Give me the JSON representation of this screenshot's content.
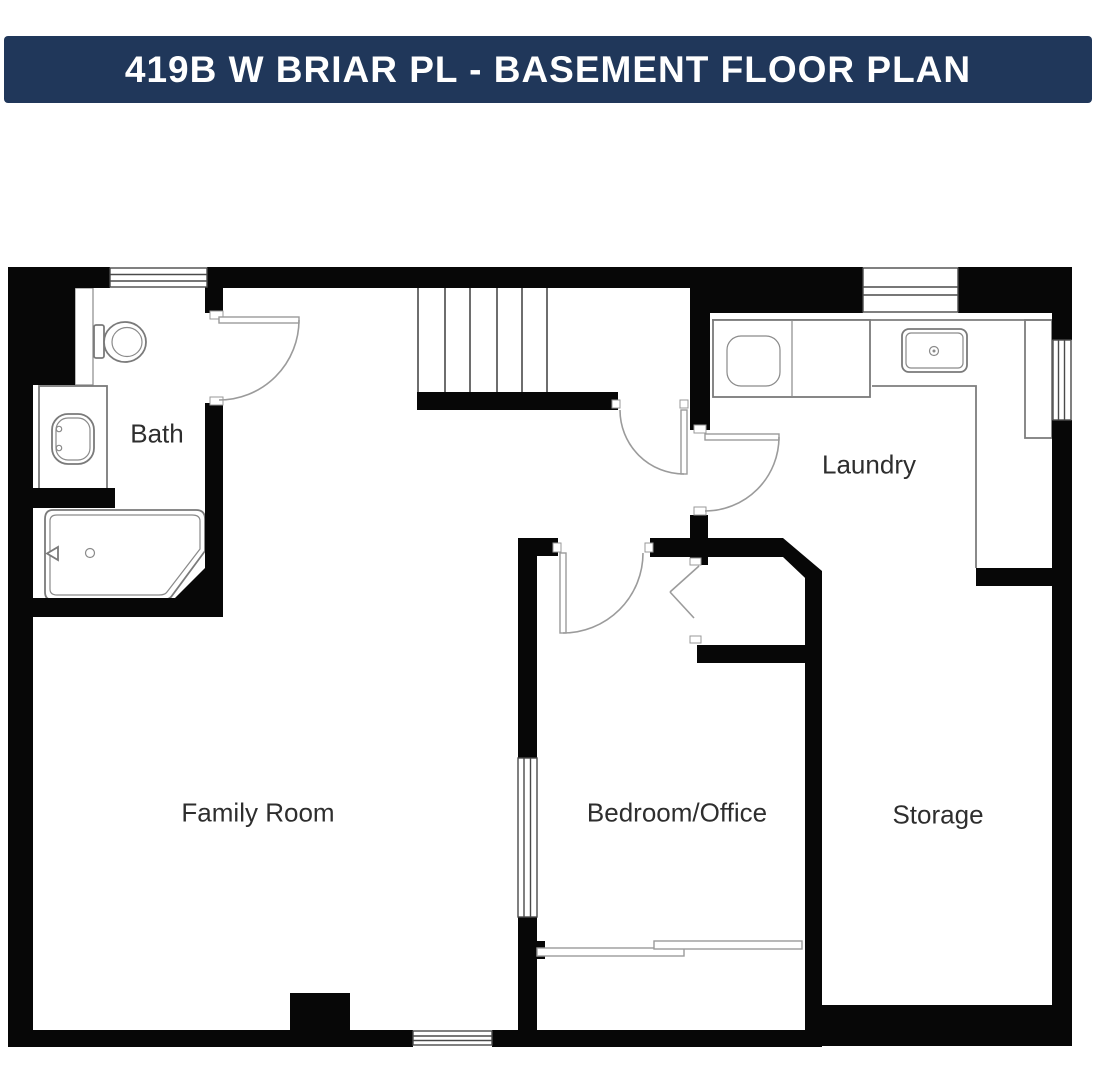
{
  "header": {
    "title": "419B W BRIAR PL - BASEMENT FLOOR PLAN"
  },
  "floor_plan": {
    "rooms": [
      {
        "name": "Bath"
      },
      {
        "name": "Laundry"
      },
      {
        "name": "Family Room"
      },
      {
        "name": "Bedroom/Office"
      },
      {
        "name": "Storage"
      }
    ],
    "fixtures": [
      "toilet",
      "bathroom-sink",
      "bathtub",
      "washer-dryer",
      "laundry-sink",
      "counter",
      "stairs",
      "sliding-door",
      "bifold-closet-doors"
    ],
    "colors": {
      "header_bg": "#20375a",
      "header_text": "#ffffff",
      "wall": "#070707",
      "fixture_line": "#7a7a7a",
      "label_text": "#2e2e2e"
    }
  }
}
